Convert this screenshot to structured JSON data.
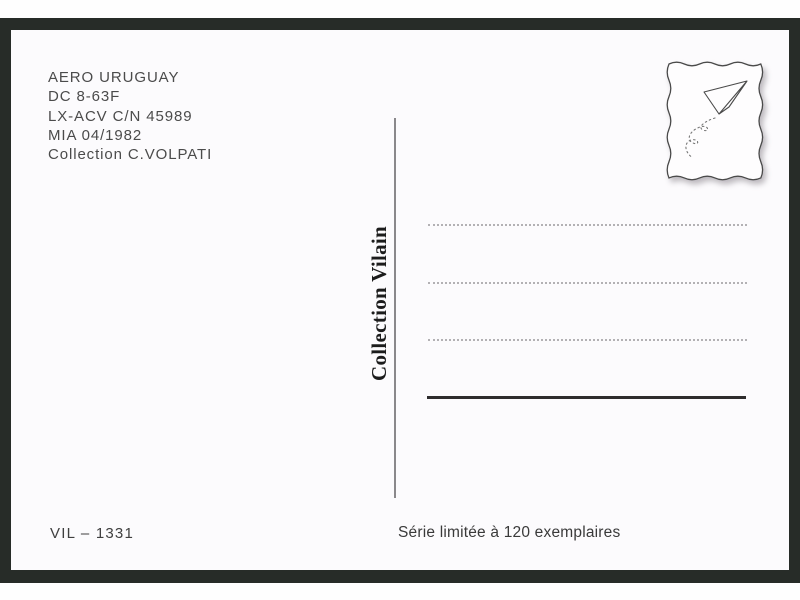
{
  "postcard": {
    "caption": {
      "lines": [
        "AERO URUGUAY",
        "DC 8-63F",
        "LX-ACV C/N 45989",
        "MIA 04/1982",
        "Collection C.VOLPATI"
      ]
    },
    "spine_label": "Collection Vilain",
    "catalog_number": "VIL – 1331",
    "edition_note": "Série limitée à 120 exemplaires",
    "stamp": {
      "icon": "paper-airplane-icon"
    },
    "address_lines": {
      "dotted_count": 3,
      "solid_count": 1
    },
    "colors": {
      "frame": "#272c28",
      "card": "#fcfbfd",
      "caption_text": "#4b4b4b",
      "spine_text": "#1c1c1c",
      "dotted_line": "#b3b1b4",
      "solid_line": "#2e2c2d"
    }
  }
}
